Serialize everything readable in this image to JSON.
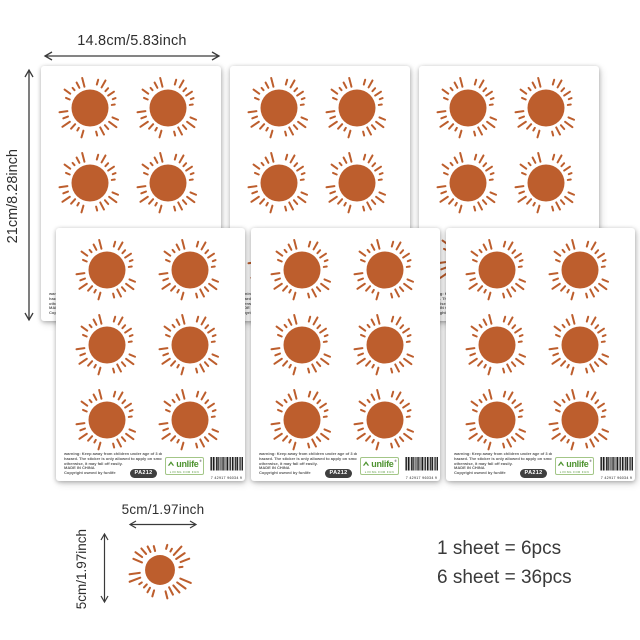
{
  "canvas": {
    "background": "#ffffff"
  },
  "annotations": {
    "sheet_width": "14.8cm/5.83inch",
    "sheet_height": "21cm/8.28inch",
    "sticker_width": "5cm/1.97inch",
    "sticker_height": "5cm/1.97inch"
  },
  "layout_counts": {
    "back_sheets": 3,
    "front_sheets": 3
  },
  "sheet": {
    "suns_per_sheet": 6,
    "warning_lines": [
      "warning: Keep away from children under age of 3 due to choking",
      "hazard. The sticker is only allowed to apply on smooth surface,",
      "otherwise, it may fall off easily.",
      "MADE IN CHINA",
      "Copyright owned by funlife"
    ],
    "product_code": "PA212",
    "brand": {
      "icon": "roof-icon",
      "text": "unlife",
      "reg_mark": "®",
      "tagline": "LIVING FOR FUN"
    },
    "barcode_digits": "7 42917 96034 9"
  },
  "sun": {
    "ray_count": 22,
    "color": "#BD5E2D"
  },
  "pack_info": {
    "line1": "1 sheet = 6pcs",
    "line2": "6 sheet = 36pcs"
  },
  "colors": {
    "dim_text": "#2e2e2e",
    "arrow": "#3a3a3a",
    "warning_text": "#5a5a5a",
    "badge_bg": "#3f3f3f",
    "badge_text": "#ffffff",
    "logo_green": "#4e9330",
    "logo_border": "#a3c687",
    "info_text": "#3a3a3a",
    "barcode_bar": "#1a1a1a"
  }
}
